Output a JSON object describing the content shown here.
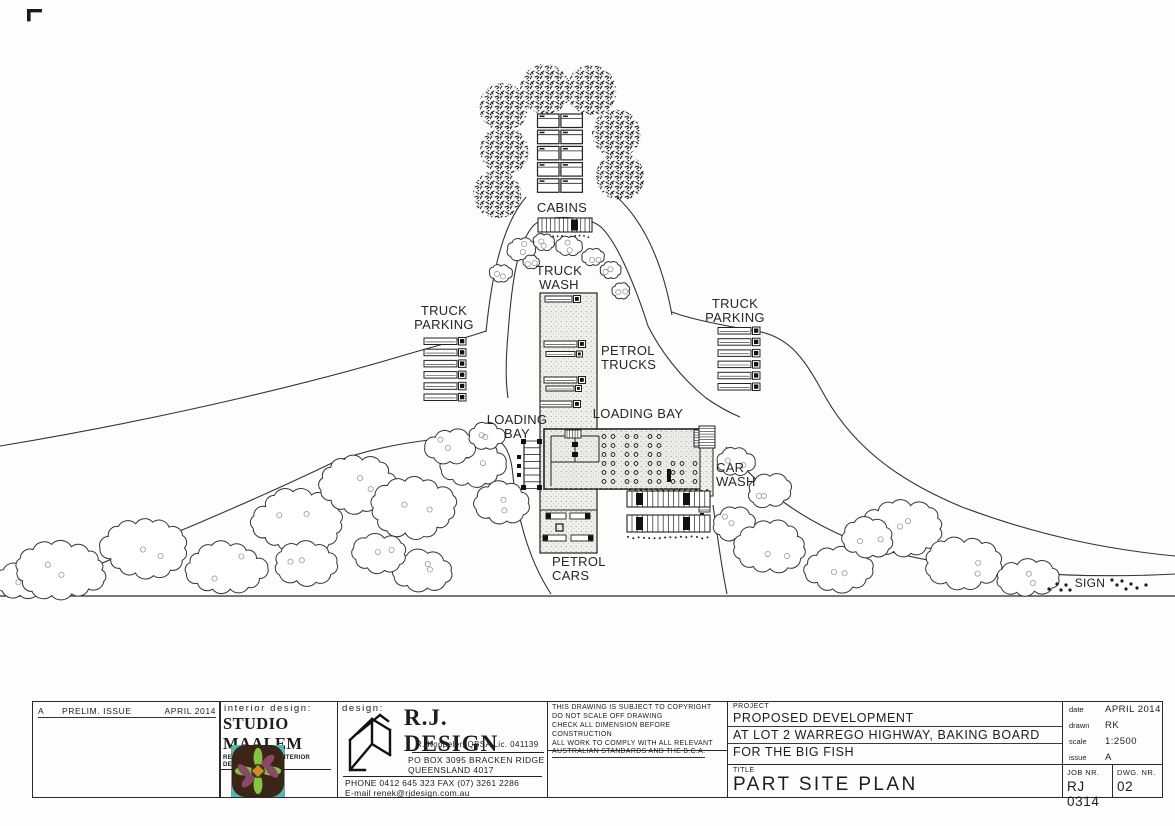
{
  "plan": {
    "labels": {
      "cabins": "CABINS",
      "truck_wash": "TRUCK\nWASH",
      "truck_parking_left": "TRUCK\nPARKING",
      "truck_parking_right": "TRUCK\nPARKING",
      "petrol_trucks": "PETROL\nTRUCKS",
      "loading_bay_left": "LOADING\nBAY",
      "loading_bay_top": "LOADING  BAY",
      "car_wash": "CAR\nWASH",
      "petrol_cars": "PETROL\nCARS",
      "sign": "SIGN"
    }
  },
  "title_block": {
    "revision": {
      "rev": "A",
      "desc": "PRELIM. ISSUE",
      "date": "APRIL 2014"
    },
    "interior": {
      "heading": "interior design:",
      "studio": "STUDIO MAALEM",
      "subtitle": "RENE KAPPELER INTERIOR DESIGNER"
    },
    "designer": {
      "heading": "design:",
      "name": "R.J. DESIGN",
      "credentials": "R. Koppeler, QBSA Lic. 041139",
      "address1": "PO BOX 3095 BRACKEN RIDGE",
      "address2": "QUEENSLAND 4017",
      "phone": "PHONE 0412 645 323   FAX (07) 3261 2286",
      "email": "E-mail renek@rjdesign.com.au"
    },
    "copyright": {
      "line1": "THIS DRAWING IS SUBJECT TO COPYRIGHT",
      "line2": "DO NOT SCALE OFF DRAWING",
      "line3": "CHECK ALL DIMENSION BEFORE CONSTRUCTION",
      "line4": "ALL WORK TO COMPLY WITH ALL RELEVANT",
      "line5": "AUSTRALIAN STANDARDS AND THE B.C.A."
    },
    "project": {
      "label": "PROJECT",
      "line1": "PROPOSED DEVELOPMENT",
      "line2": "AT LOT 2 WARREGO HIGHWAY, BAKING BOARD",
      "line3": "FOR THE BIG FISH"
    },
    "meta": {
      "date_label": "date",
      "date": "APRIL 2014",
      "drawn_label": "drawn",
      "drawn": "RK",
      "scale_label": "scale",
      "scale": "1:2500",
      "issue_label": "issue",
      "issue": "A"
    },
    "title": {
      "label": "TITLE",
      "value": "PART SITE PLAN"
    },
    "job": {
      "label": "JOB NR.",
      "value": "RJ 0314"
    },
    "dwg": {
      "label": "DWG. NR.",
      "value": "02"
    }
  },
  "colors": {
    "ink": "#222222",
    "stipple": "#aca89f",
    "logo_teal": "#4fb9b4",
    "logo_green": "#83c441",
    "logo_mauve": "#8a4a63",
    "logo_orange": "#d88a1f",
    "logo_bg": "#3a2517"
  }
}
